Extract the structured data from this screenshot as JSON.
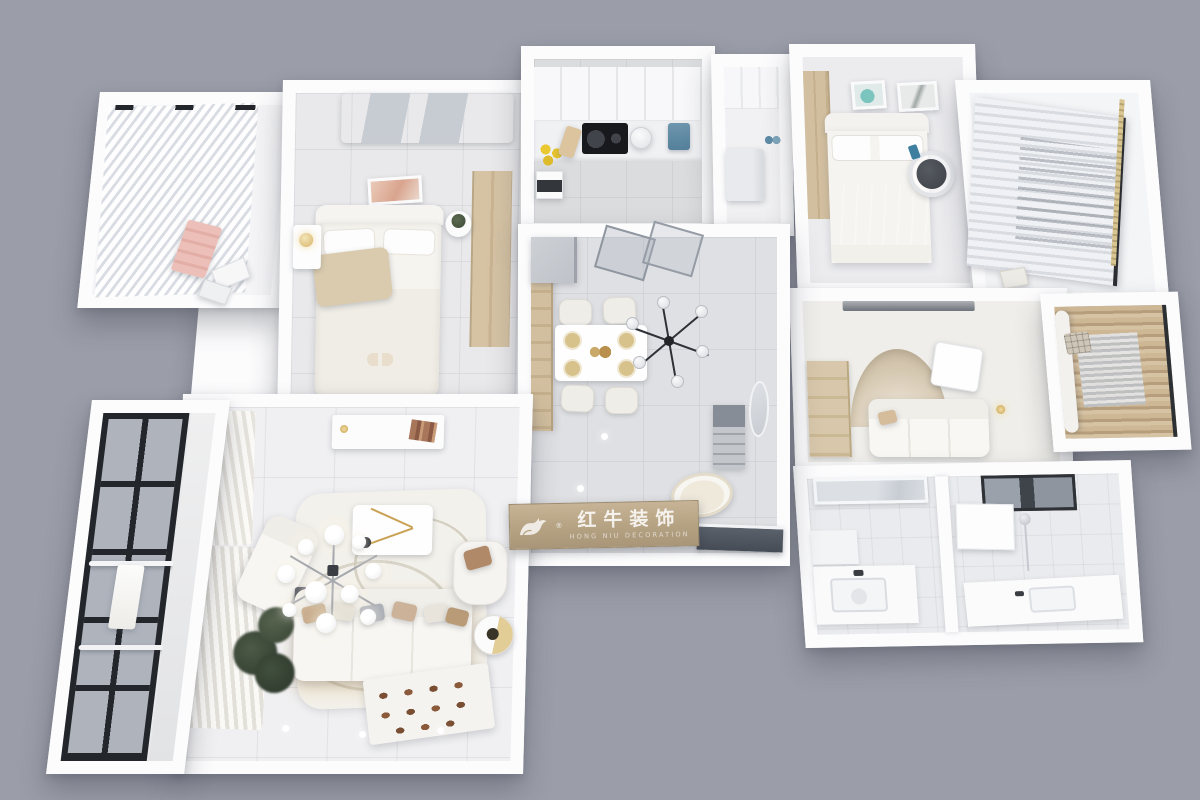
{
  "scene": {
    "description": "Top-down 3D render of a furnished three-bedroom apartment floor plan on a plain gray background",
    "rooms_depicted": [
      "balcony with sheer curtains",
      "master bedroom",
      "kitchen",
      "entry hall with fridge",
      "bedroom with wall art",
      "laundry balcony with curtain",
      "study room with white sofa and arch",
      "tatami bay with striped curtains",
      "dining room",
      "corridor with vanity sink",
      "bathroom",
      "bathroom with window",
      "living room",
      "glazed balcony with drying rack"
    ]
  },
  "watermark": {
    "title": "红牛装饰",
    "subtitle": "HONG NIU DECORATION",
    "registered_mark": "®",
    "logo": "bull-icon"
  },
  "palette": {
    "background": "#9B9EA9",
    "walls": "#FCFCFD",
    "floor_cool_gray": "#E0E1E4",
    "floor_warm_white": "#F0F0F2",
    "wood_cabinet": "#D0BD9D",
    "watermark_wood": "#B5A283",
    "gray_textile": "#A6AAB2",
    "tan_textile": "#D8CBB0",
    "plant_green": "#42503E",
    "window_frame_black": "#23262A",
    "appliance_blue": "#5E8CA6",
    "pink_textile": "#E9BCB6",
    "brass_gold": "#C9A254"
  }
}
